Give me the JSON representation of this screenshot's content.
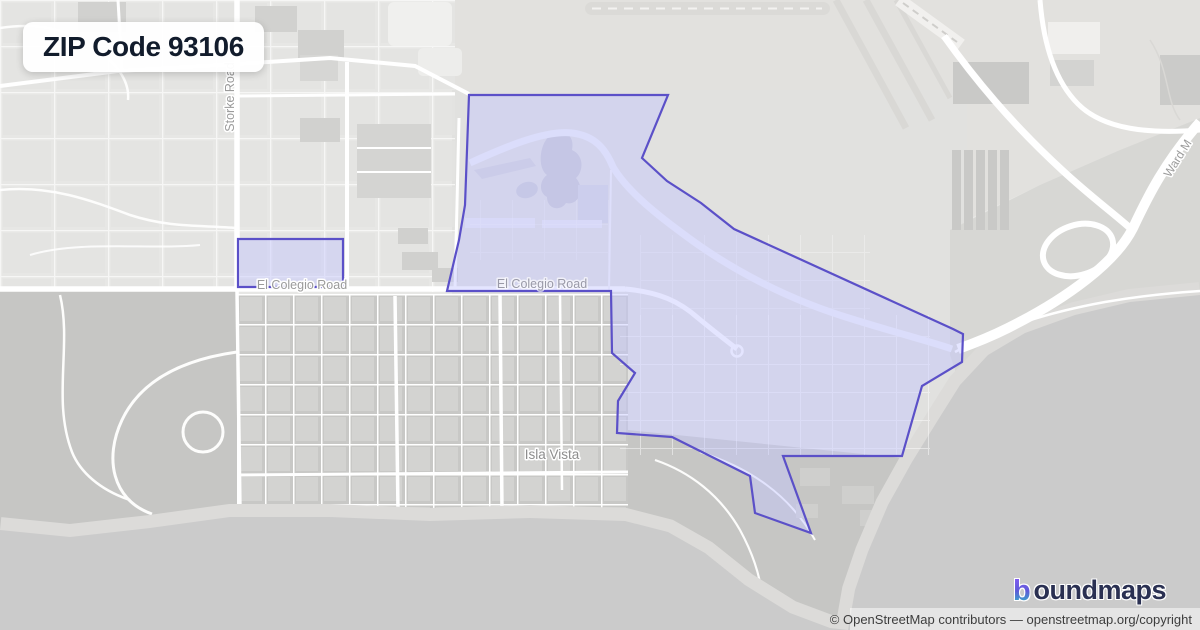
{
  "badge": {
    "title": "ZIP Code 93106"
  },
  "map": {
    "labels": {
      "storke_road": "Storke Road",
      "el_colegio_west": "El Colegio Road",
      "el_colegio_campus": "El Colegio Road",
      "isla_vista": "Isla Vista",
      "ward_memorial": "Ward M"
    },
    "boundary": {
      "zip": "93106",
      "stroke_color": "#5b50c8",
      "fill_color": "rgba(195,197,255,0.45)",
      "main_points": "469,95 668,95 642,158 667,181 701,203 734,229 953,329 963,334 962,362 922,386 902,456 783,456 811,533 755,513 750,476 672,437 617,433 618,401 635,373 612,353 611,291 447,291 459,240 465,205",
      "secondary_points": "238,239 343,239 343,287 238,287"
    },
    "colors": {
      "land": "#e7e7e5",
      "airport": "#e2e1de",
      "open_space": "#c6c6c4",
      "isla_vista_block": "#c8c8c6",
      "beach": "#dcdbd9",
      "ocean": "#cbcbcb",
      "road": "#ffffff"
    }
  },
  "logo": {
    "icon_letter": "b",
    "wordmark": "oundmaps",
    "gradient_top": "#8b5cf6",
    "gradient_bottom": "#2bc8c4",
    "text_color": "#2a3052"
  },
  "attribution": {
    "text": "© OpenStreetMap contributors — openstreetmap.org/copyright"
  }
}
